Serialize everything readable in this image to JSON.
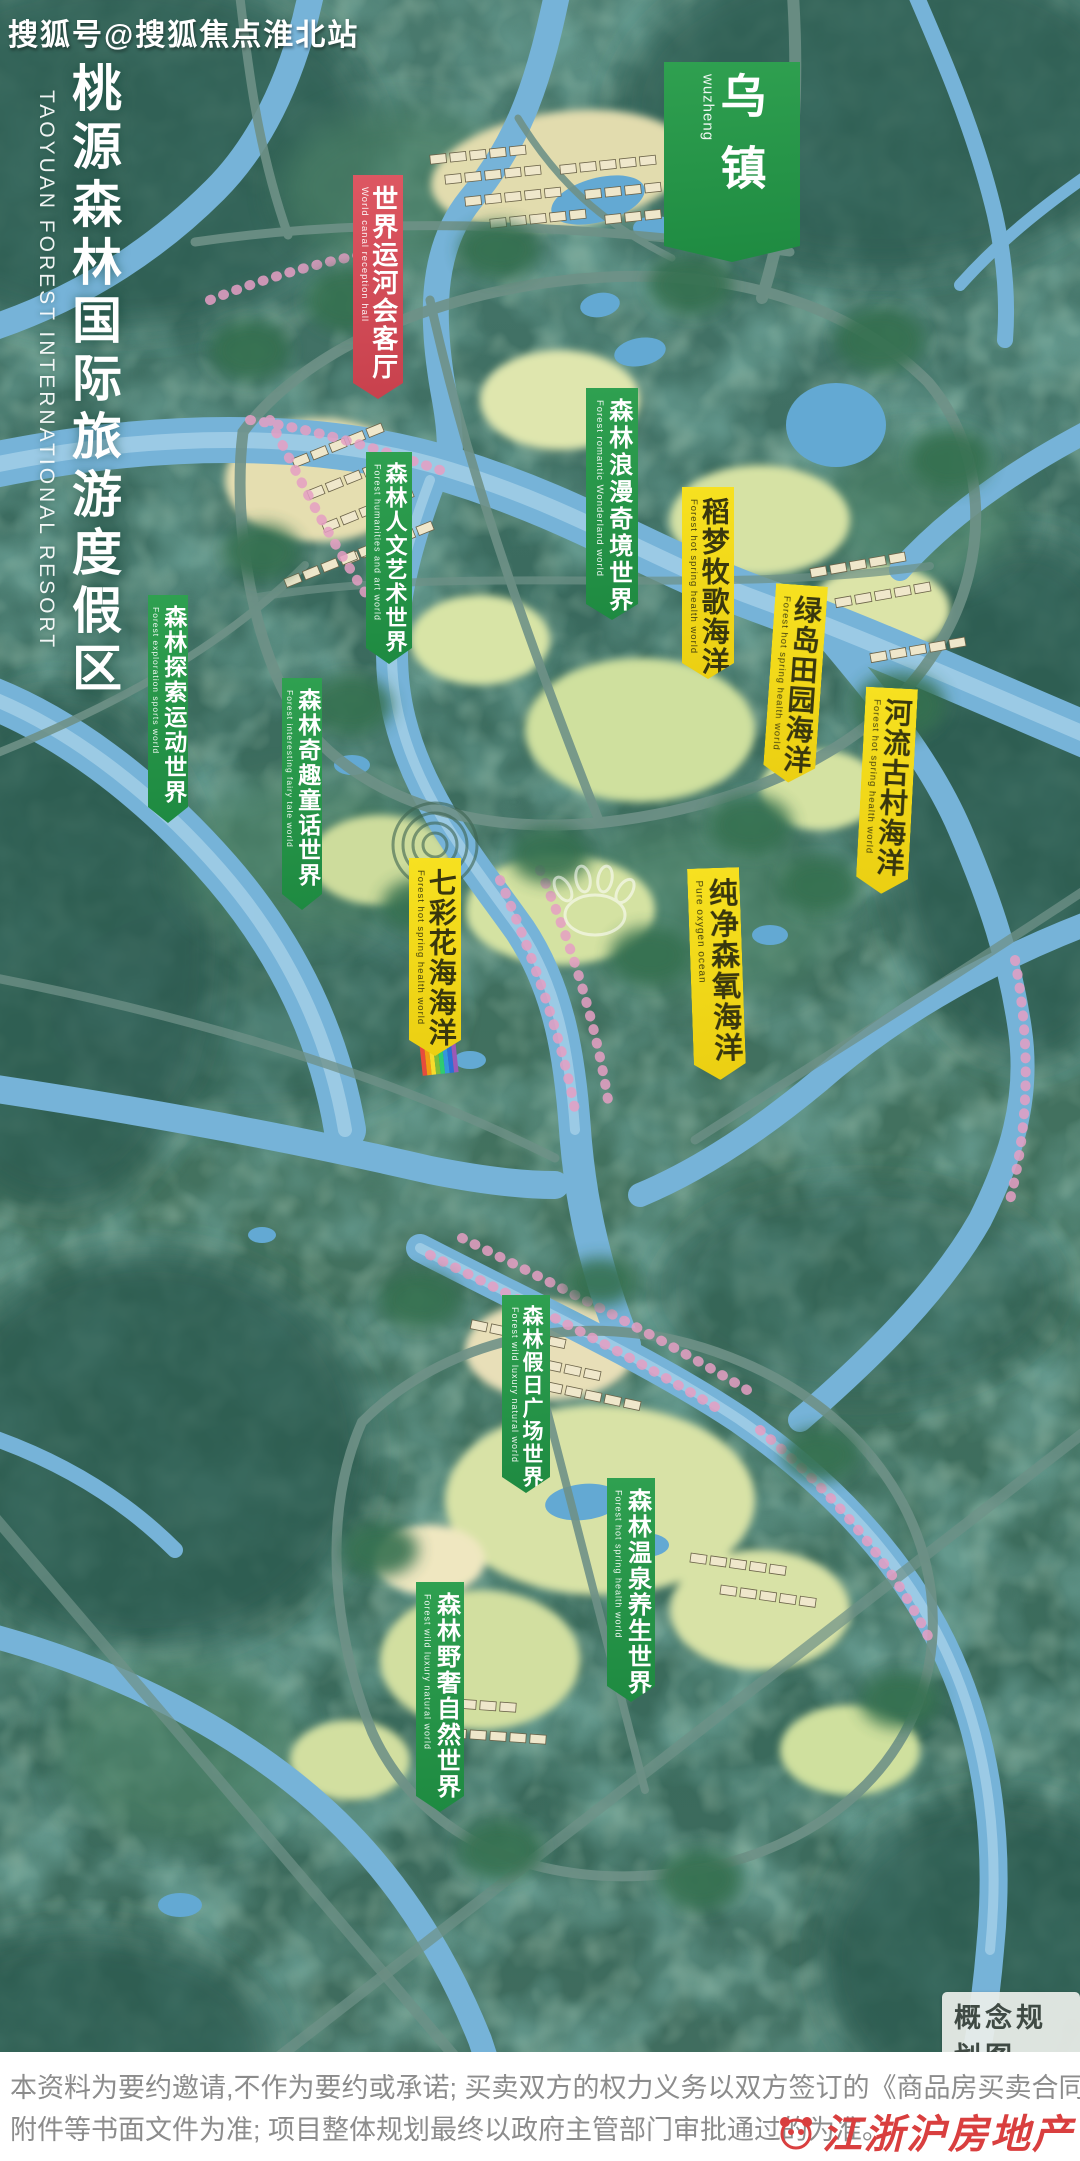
{
  "watermark_top": "搜狐号@搜狐焦点淮北站",
  "title": {
    "cn": "桃源森林国际旅游度假区",
    "en": "TAOYUAN FOREST INTERNATIONAL RESORT"
  },
  "colors": {
    "green_banner": "#2fa050",
    "yellow_banner": "#f3da1e",
    "red_banner": "#d8515a",
    "brand_red": "#d93f3f"
  },
  "banners": [
    {
      "id": "wuzhen",
      "cn": "乌镇",
      "en": "wuzheng",
      "color": "green",
      "x": 664,
      "y": 62,
      "w": 136,
      "h": 200,
      "fs": 46,
      "es": 15,
      "ls": 26,
      "rot": 0
    },
    {
      "id": "world-canal-hall",
      "cn": "世界运河会客厅",
      "en": "World canal reception hall",
      "color": "red",
      "x": 353,
      "y": 175,
      "w": 50,
      "h": 224,
      "fs": 26,
      "es": 9.5,
      "ls": 2,
      "rot": 0
    },
    {
      "id": "forest-humanities-art-world",
      "cn": "森林人文艺术世界",
      "en": "Forest humanities and art world",
      "color": "green",
      "x": 366,
      "y": 452,
      "w": 46,
      "h": 212,
      "fs": 22,
      "es": 9,
      "ls": 2,
      "rot": 0
    },
    {
      "id": "forest-romantic-wonderland-world",
      "cn": "森林浪漫奇境世界",
      "en": "Forest romantic Wonderland world",
      "color": "green",
      "x": 586,
      "y": 388,
      "w": 52,
      "h": 232,
      "fs": 24,
      "es": 9.5,
      "ls": 3,
      "rot": 0
    },
    {
      "id": "rice-dream-pastoral-ocean",
      "cn": "稻梦牧歌海洋",
      "en": "Forest hot spring health world",
      "color": "yellow",
      "x": 682,
      "y": 487,
      "w": 52,
      "h": 192,
      "fs": 28,
      "es": 9.5,
      "ls": 2,
      "rot": 0
    },
    {
      "id": "green-island-countryside-ocean",
      "cn": "绿岛田园海洋",
      "en": "Forest hot spring health world",
      "color": "yellow",
      "x": 776,
      "y": 585,
      "w": 52,
      "h": 198,
      "fs": 28,
      "es": 9.5,
      "ls": 2,
      "rot": 4
    },
    {
      "id": "river-ancient-village-ocean",
      "cn": "河流古村海洋",
      "en": "Forest hot spring health world",
      "color": "yellow",
      "x": 866,
      "y": 688,
      "w": 52,
      "h": 206,
      "fs": 28,
      "es": 9.5,
      "ls": 2,
      "rot": 3
    },
    {
      "id": "colorful-flower-sea-ocean",
      "cn": "七彩花海海洋",
      "en": "Forest hot spring health world",
      "color": "yellow",
      "x": 409,
      "y": 858,
      "w": 52,
      "h": 198,
      "fs": 28,
      "es": 9.5,
      "ls": 2,
      "rot": 0
    },
    {
      "id": "pure-oxygen-ocean",
      "cn": "纯净森氧海洋",
      "en": "Pure oxygen ocean",
      "color": "yellow",
      "x": 687,
      "y": 868,
      "w": 52,
      "h": 212,
      "fs": 29,
      "es": 10,
      "ls": 2,
      "rot": -2
    },
    {
      "id": "forest-fairy-tale-world",
      "cn": "森林奇趣童话世界",
      "en": "Forest interesting fairy tale world",
      "color": "green",
      "x": 282,
      "y": 678,
      "w": 40,
      "h": 232,
      "fs": 23,
      "es": 8.5,
      "ls": 2,
      "rot": 0
    },
    {
      "id": "forest-exploration-sports-world",
      "cn": "森林探索运动世界",
      "en": "Forest exploration sports world",
      "color": "green",
      "x": 148,
      "y": 595,
      "w": 40,
      "h": 228,
      "fs": 23,
      "es": 8.5,
      "ls": 2,
      "rot": 0
    },
    {
      "id": "forest-holiday-plaza-world",
      "cn": "森林假日广场世界",
      "en": "Forest wild luxury natural world",
      "color": "green",
      "x": 502,
      "y": 1295,
      "w": 48,
      "h": 198,
      "fs": 21,
      "es": 9,
      "ls": 2,
      "rot": 0
    },
    {
      "id": "forest-hot-spring-health-world",
      "cn": "森林温泉养生世界",
      "en": "Forest hot spring health world",
      "color": "green",
      "x": 607,
      "y": 1478,
      "w": 48,
      "h": 224,
      "fs": 24,
      "es": 9,
      "ls": 2,
      "rot": 0
    },
    {
      "id": "forest-wild-luxury-natural-world",
      "cn": "森林野奢自然世界",
      "en": "Forest wild luxury natural world",
      "color": "green",
      "x": 416,
      "y": 1582,
      "w": 48,
      "h": 230,
      "fs": 24,
      "es": 9,
      "ls": 2,
      "rot": 0
    }
  ],
  "map_tag": "概念规划图",
  "footer": {
    "line1": "本资料为要约邀请,不作为要约或承诺; 买卖双方的权力义务以双方签订的《商品房买卖合同》及其补充协议、",
    "line2": "附件等书面文件为准; 项目整体规划最终以政府主管部门审批通过的为准。"
  },
  "brand_watermark": "江浙沪房地产"
}
